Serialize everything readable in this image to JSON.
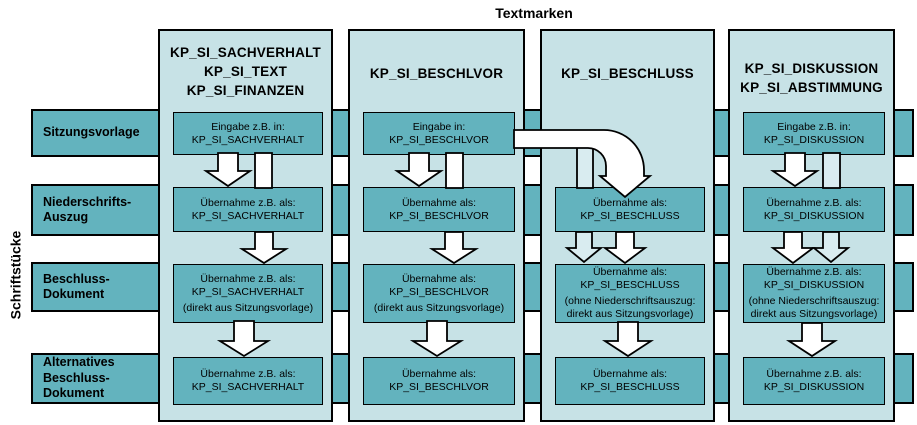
{
  "title": "Textmarken",
  "side_label": "Schriftstücke",
  "colors": {
    "page_bg": "#ffffff",
    "band_teal": "#63b3be",
    "column_bg": "#c7e2e6",
    "arrow_light": "#d9ecf0",
    "arrow_white": "#ffffff",
    "border": "#000000"
  },
  "rows": [
    {
      "label_lines": [
        "Sitzungsvorlage"
      ]
    },
    {
      "label_lines": [
        "Niederschrifts-",
        "Auszug"
      ]
    },
    {
      "label_lines": [
        "Beschluss-",
        "Dokument"
      ]
    },
    {
      "label_lines": [
        "Alternatives",
        "Beschluss-",
        "Dokument"
      ]
    }
  ],
  "columns": [
    {
      "header_lines": [
        "KP_SI_SACHVERHALT",
        "KP_SI_TEXT",
        "KP_SI_FINANZEN"
      ],
      "cells": [
        {
          "lines": [
            "Eingabe z.B. in:",
            "KP_SI_SACHVERHALT"
          ]
        },
        {
          "lines": [
            "Übernahme z.B. als:",
            "KP_SI_SACHVERHALT"
          ]
        },
        {
          "lines": [
            "Übernahme z.B. als:",
            "KP_SI_SACHVERHALT"
          ],
          "note_lines": [
            "(direkt aus Sitzungsvorlage)"
          ]
        },
        {
          "lines": [
            "Übernahme z.B. als:",
            "KP_SI_SACHVERHALT"
          ]
        }
      ]
    },
    {
      "header_lines": [
        "KP_SI_BESCHLVOR"
      ],
      "cells": [
        {
          "lines": [
            "Eingabe in:",
            "KP_SI_BESCHLVOR"
          ]
        },
        {
          "lines": [
            "Übernahme als:",
            "KP_SI_BESCHLVOR"
          ]
        },
        {
          "lines": [
            "Übernahme als:",
            "KP_SI_BESCHLVOR"
          ],
          "note_lines": [
            "(direkt aus Sitzungsvorlage)"
          ]
        },
        {
          "lines": [
            "Übernahme als:",
            "KP_SI_BESCHLVOR"
          ]
        }
      ]
    },
    {
      "header_lines": [
        "KP_SI_BESCHLUSS"
      ],
      "cells": [
        null,
        {
          "lines": [
            "Übernahme als:",
            "KP_SI_BESCHLUSS"
          ]
        },
        {
          "lines": [
            "Übernahme als:",
            "KP_SI_BESCHLUSS"
          ],
          "note_lines": [
            "(ohne Niederschriftsauszug:",
            "direkt aus Sitzungsvorlage)"
          ]
        },
        {
          "lines": [
            "Übernahme als:",
            "KP_SI_BESCHLUSS"
          ]
        }
      ]
    },
    {
      "header_lines": [
        "KP_SI_DISKUSSION",
        "KP_SI_ABSTIMMUNG"
      ],
      "cells": [
        {
          "lines": [
            "Eingabe z.B. in:",
            "KP_SI_DISKUSSION"
          ]
        },
        {
          "lines": [
            "Übernahme z.B. als:",
            "KP_SI_DISKUSSION"
          ]
        },
        {
          "lines": [
            "Übernahme z.B. als:",
            "KP_SI_DISKUSSION"
          ],
          "note_lines": [
            "(ohne Niederschriftsauszug:",
            "direkt aus Sitzungsvorlage)"
          ]
        },
        {
          "lines": [
            "Übernahme z.B. als:",
            "KP_SI_DISKUSSION"
          ]
        }
      ]
    }
  ]
}
